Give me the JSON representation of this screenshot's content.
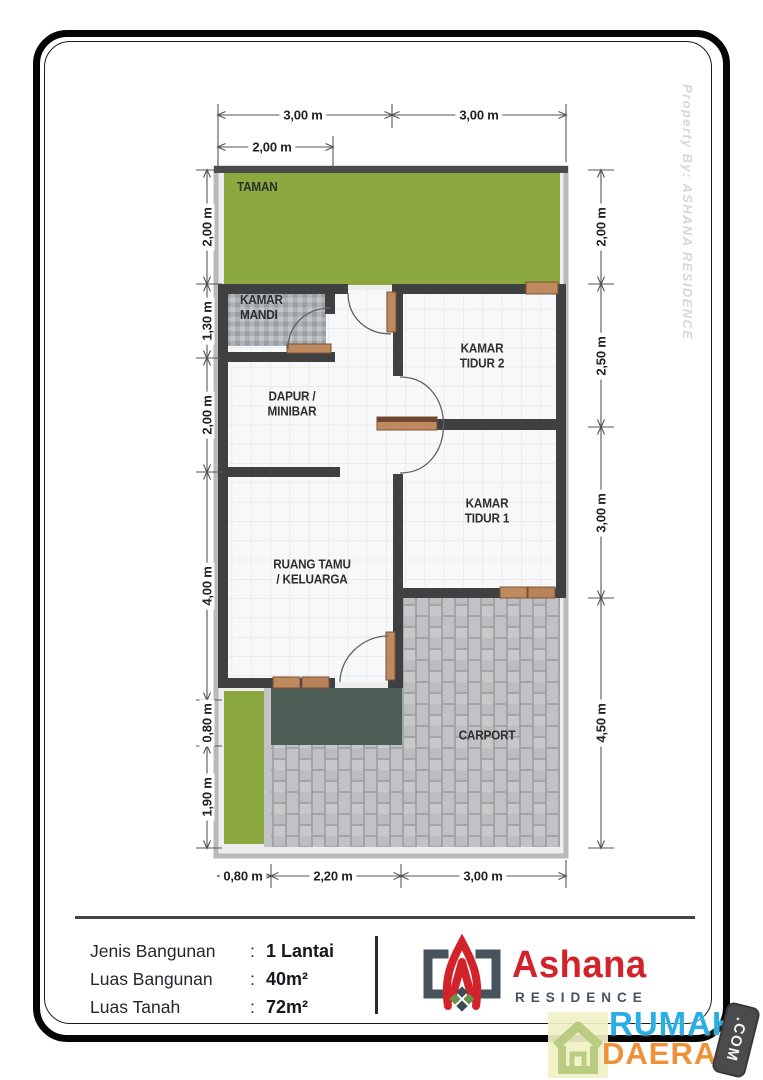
{
  "side_credit": "Property By: ASHANA RESIDENCE",
  "plan": {
    "rooms": {
      "taman": "TAMAN",
      "kamar_mandi": "KAMAR\nMANDI",
      "dapur": "DAPUR /\nMINIBAR",
      "kamar_tidur_2": "KAMAR\nTIDUR 2",
      "kamar_tidur_1": "KAMAR\nTIDUR 1",
      "ruang_tamu": "RUANG TAMU\n/ KELUARGA",
      "carport": "CARPORT"
    },
    "dims": {
      "top": [
        "3,00 m",
        "3,00 m"
      ],
      "top_inner": "2,00 m",
      "left": [
        "2,00 m",
        "1,30 m",
        "2,00 m",
        "4,00 m",
        "0,80 m",
        "1,90 m"
      ],
      "right": [
        "2,00 m",
        "2,50 m",
        "3,00 m",
        "4,50 m"
      ],
      "bottom": [
        "0,80 m",
        "2,20 m",
        "3,00 m"
      ]
    },
    "colors": {
      "garden": "#8ba93f",
      "wall": "#3f4042",
      "terrace": "#4d5e57",
      "door_wood": "#c08a5f",
      "carport_brick": "#c0c2c5"
    }
  },
  "info": {
    "colon": ":",
    "rows": [
      {
        "label": "Jenis Bangunan",
        "value": "1 Lantai"
      },
      {
        "label": "Luas Bangunan",
        "value": "40m²"
      },
      {
        "label": "Luas Tanah",
        "value": "72m²"
      }
    ]
  },
  "logo": {
    "name": "Ashana",
    "subtitle": "RESIDENCE",
    "red": "#d2232a",
    "slate": "#47545d"
  },
  "badge": {
    "word1": "RUMAH",
    "word2": "DAERAH",
    "tag": ".COM",
    "blue": "#2aaee6",
    "orange": "#ef9138"
  }
}
